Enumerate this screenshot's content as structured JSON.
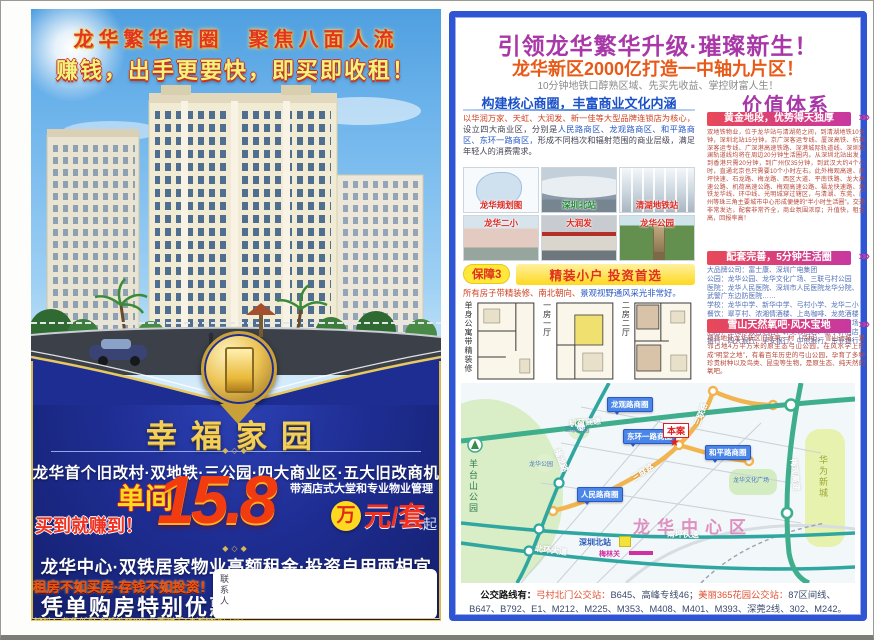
{
  "left_page": {
    "header_line1": "龙华繁华商圈　聚焦八面人流",
    "header_line2": "赚钱，出手更要快，即买即收租！",
    "logo_title": "幸福家园",
    "ornament": "◆◇◆",
    "features_line": "龙华首个旧改村·双地铁·三公园·四大商业区·五大旧改商机",
    "price": {
      "unit_type": "单间",
      "slogan": "买到就赚到！",
      "number": "15.8",
      "wan": "万",
      "unit": "元/套",
      "qi": "起",
      "note": "带酒店式大堂和专业物业管理"
    },
    "line_center": "龙华中心·双铁居家物业高额租金·投资自用两相宜",
    "line_red": "租房不如买房·存钱不如投资！",
    "line_offer": "凭单购房特别优惠",
    "address": "地址：龙华新区清湖美丽365花园附近(清湖地铁口旁)",
    "contact_label": "联系人"
  },
  "right_page": {
    "title": "引领龙华繁华升级·璀璨新生！",
    "subtitle": "龙华新区2000亿打造一中轴九片区！",
    "tagline": "10分钟地铁口醇熟区域、先买先收益、掌控财富人生！",
    "commerce": {
      "title": "构建核心商圈，丰富商业文化内涵",
      "para_seg1": "以华润万家、天虹、大润发、新一佳等大型品牌连锁店为核心，",
      "para_seg2": "设立四大商业区，分别是",
      "para_seg3": "人民路商区、龙观路商区、和平路商区、东环一路商区，",
      "para_seg4": "形成不同档次和辐射范围的商业层级，满足年轻人的消费需求。",
      "photos": [
        {
          "caption": "龙华规划图"
        },
        {
          "caption": "深圳北站"
        },
        {
          "caption": "清湖地铁站"
        },
        {
          "caption": "龙华二小"
        },
        {
          "caption": "大润发"
        },
        {
          "caption": "龙华公园"
        }
      ]
    },
    "guarantee": {
      "badge": "保障3",
      "title": "精装小户 投资首选",
      "note_seg1": "所有房子带精装修、南北朝向、",
      "note_seg2": "景观视野通风采光非常好。",
      "floorplans": [
        {
          "label": "单身公寓带精装修"
        },
        {
          "label": "一房一厅"
        },
        {
          "label": "二房二厅"
        }
      ]
    },
    "value_system": {
      "title": "价值体系",
      "chevron": "»»",
      "sections": [
        {
          "header": "黄金地段，优势得天独厚",
          "body": "双地铁物业，位于龙华站与清湖苑之间，到清湖地铁10分钟，深圳北站15分钟，京广深客运专线、厦深高铁、杭福深客运专线、广深港高速铁路、深港城际轨道线、深圳观澜轨道线均将在周边20分钟生活圈内。从深圳北站出发，到香港只需20分钟，到广州仅35分钟，到武汉大约4个小时，直通北京也只需要10个小时左右。此外梅观高速、南坪快速、石龙路、梅龙路、西区大道、平南铁路、龙大高速公路、机荷高速公路、梅观高速公路、福龙快速路、地铁龙华线、环中线、光明城穿过辖区，与清湖、东莞、广州等珠三角主要城市中心形成便捷的“半小时生活圈”。交通非常发达，配套非常齐全，商业氛围浓厚；升值快，租金高，回报率高！"
        },
        {
          "header": "配套完善，5分钟生活圈",
          "lines": [
            "大品牌公司：富士康、深圳广电集团",
            "公园：龙华公园、龙华文化广场、三联弓村公园",
            "医院：龙华人民医院、深圳市人民医院龙华分院、武警广东边防医院……",
            "学校：龙华中学、新华中学、弓村小学、龙华二小",
            "餐饮：翠亨村、浓湘情酒楼、上岛咖啡、龙苑酒楼",
            "购物：大润发、华润万家、佳华商场、第一佳市场",
            "酒店：圣淘沙假日酒店、轩美邻酒店、新宇轩酒店",
            "银行：四大银行、平安银行、中信银行、东亚银行"
          ]
        },
        {
          "header": "雪山天然氧吧·风水宝地",
          "body": "项目地处龙华新区旧改第一村（弓村），雪山边城，紧邻占地4万平方米的原生态弓山公园，在风水学上形成“明堂之地”，有着百年历史的弓山公园，孕育了多种珍贵树种以及鸟类、昆虫等生物，是原生态、纯天然的氧吧。"
        }
      ]
    },
    "map": {
      "labels": {
        "expressway_top": "机荷高速",
        "fulong_road": "福龙路",
        "yangtaishan_park": "羊台山公园",
        "huawei_area": "华为新城",
        "meiguan_expressway": "梅观高速",
        "nanping_expressway": "南坪快速",
        "beihuan_avenue": "北环大道",
        "sanlian_road": "三联路",
        "longguan_circle": "龙观路商圈",
        "donghuan_circle": "东环一路商圈",
        "renmin_circle": "人民路商圈",
        "heping_circle": "和平路商圈",
        "site": "本案",
        "site_star": "★",
        "center_district": "龙华中心区",
        "north_station": "深圳北站",
        "meilin_pass": "梅林关",
        "culture_square": "龙华文化广场",
        "sanlian_park": "三联公园",
        "longhua_park": "龙华公园"
      },
      "bus": {
        "prefix": "公交路线有：",
        "stop1": "弓村北门公交站：",
        "routes1": "B645、高峰专线46；",
        "stop2": "美丽365花园公交站：",
        "routes2": "87区间线、B647、B792、E1、M212、M225、M353、M408、M401、M393、深莞2线、302、M242。"
      }
    },
    "colors": {
      "accent_magenta": "#a838a8",
      "accent_red": "#e85a18",
      "frame_blue": "#2f55d4",
      "gold": "#e8c860",
      "navy": "#1e2d92"
    }
  }
}
